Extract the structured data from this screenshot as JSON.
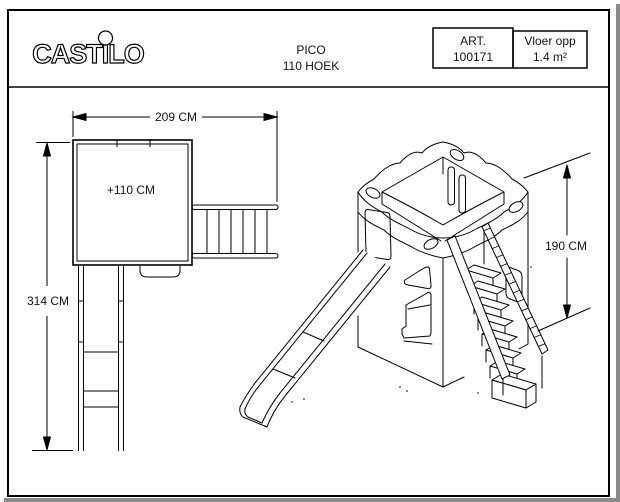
{
  "header": {
    "brand": "CASTILO",
    "product_line1": "PICO",
    "product_line2": "110 HOEK",
    "art_label": "ART.",
    "art_number": "100171",
    "floor_label": "Vloer opp",
    "floor_value": "1.4 m²"
  },
  "plan_view": {
    "width_dim": "209 CM",
    "height_dim": "314 CM",
    "platform_height": "+110 CM"
  },
  "iso_view": {
    "tower_height_dim": "190 CM"
  },
  "colors": {
    "line": "#000000",
    "paper": "#ffffff",
    "edge_shadow": "#8a8a8a"
  }
}
